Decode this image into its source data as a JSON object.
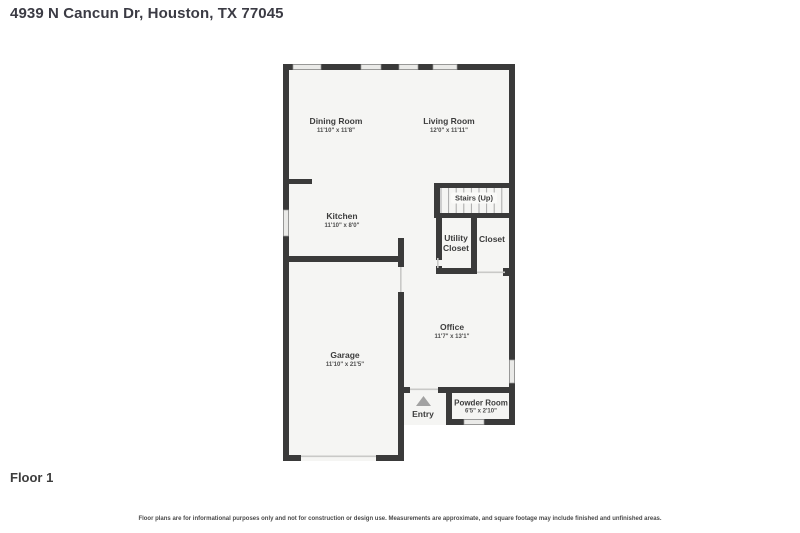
{
  "page": {
    "title": "4939 N Cancun Dr, Houston, TX 77045",
    "floor_label": "Floor 1",
    "disclaimer": "Floor plans are for informational purposes only and not for construction or design use. Measurements are approximate, and square footage may include finished and unfinished areas."
  },
  "floor_plan": {
    "rooms": [
      {
        "name": "Dining Room",
        "dimensions": "11'10\" x 11'8\""
      },
      {
        "name": "Living Room",
        "dimensions": "12'0\" x 11'11\""
      },
      {
        "name": "Kitchen",
        "dimensions": "11'10\" x 8'0\""
      },
      {
        "name": "Stairs (Up)",
        "dimensions": ""
      },
      {
        "name": "Utility Closet",
        "dimensions": ""
      },
      {
        "name": "Closet",
        "dimensions": ""
      },
      {
        "name": "Garage",
        "dimensions": "11'10\" x 21'5\""
      },
      {
        "name": "Office",
        "dimensions": "11'7\" x 13'1\""
      },
      {
        "name": "Entry",
        "dimensions": ""
      },
      {
        "name": "Powder Room",
        "dimensions": "6'5\" x 2'10\""
      }
    ],
    "icons": {
      "entry_arrow": "triangle-up"
    },
    "colors": {
      "wall": "#3a3a3a",
      "room_fill": "#f5f5f3",
      "window_fill": "#eaeae8",
      "opening_line": "#c9c9c7",
      "stair_tread": "#a8a8a8",
      "entry_arrow": "#a2a2a2"
    }
  }
}
